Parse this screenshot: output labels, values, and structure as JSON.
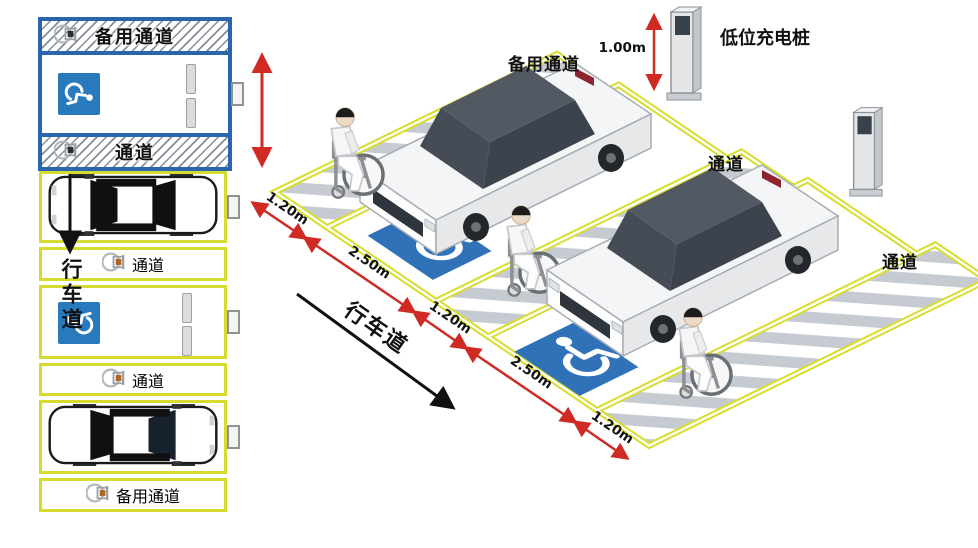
{
  "colors": {
    "blue_border": "#2a66ad",
    "yellow_marking": "#d6dc2e",
    "sign_blue": "#2979bd",
    "dimension_red": "#cf2b24",
    "hatch_gray_plan": "#878d95",
    "hatch_gray_iso": "#c6cbd2"
  },
  "plan_view": {
    "drive_lane_label": "行车道",
    "bands": [
      {
        "label": "备用通道"
      },
      {
        "label": "通道"
      },
      {
        "label": "通道"
      },
      {
        "label": "通道"
      },
      {
        "label": "备用通道"
      }
    ]
  },
  "iso_view": {
    "charger_label": "低位充电桩",
    "charger_height_dim": "1.00m",
    "reserve_aisle_label": "备用通道",
    "aisle_labels": [
      {
        "label": "通道"
      },
      {
        "label": "通道"
      }
    ],
    "drive_lane_label": "行车道",
    "front_dims": [
      {
        "label": "1.20m"
      },
      {
        "label": "2.50m"
      },
      {
        "label": "1.20m"
      },
      {
        "label": "2.50m"
      },
      {
        "label": "1.20m"
      }
    ]
  }
}
